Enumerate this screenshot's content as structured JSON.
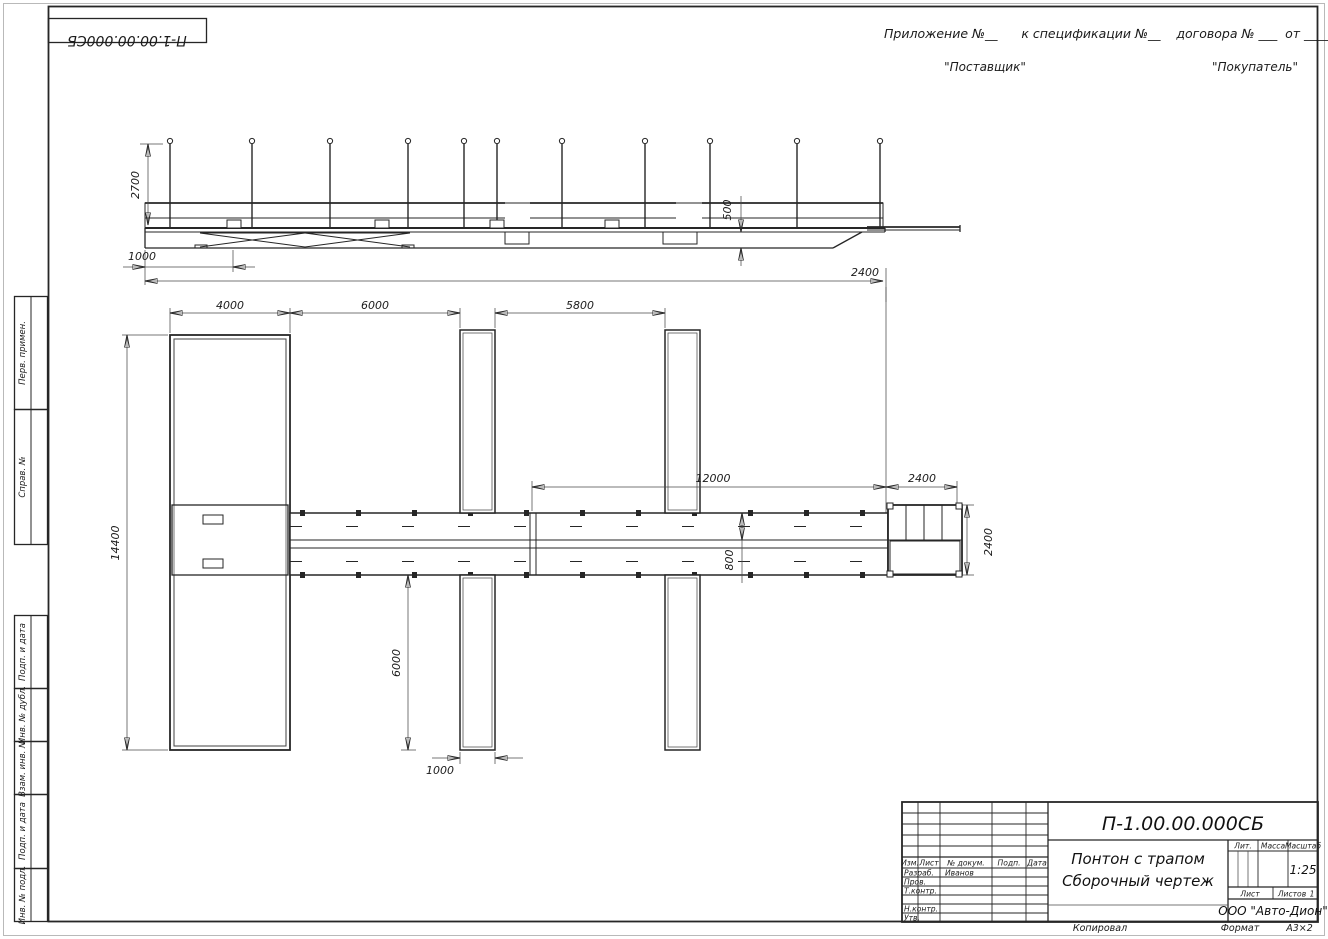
{
  "drawing": {
    "stamp_rotated": "П-1.00.00.000СБ",
    "appendix_line": "Приложение №__      к спецификации №__    договора № ___  от _________",
    "supplier": "\"Поставщик\"",
    "buyer": "\"Покупатель\"",
    "copied": "Копировал",
    "format_label": "Формат",
    "format_value": "А3×2"
  },
  "margin": {
    "perv": "Перв. примен.",
    "sprav": "Справ. №",
    "podp1": "Подп. и дата",
    "inv_dubl": "Инв. № дубл.",
    "vzam": "Взам. инв. №",
    "podp2": "Подп. и дата",
    "inv_podl": "Инв. № подл."
  },
  "dims": {
    "e_height": "2700",
    "e_offset": "1000",
    "e_draft": "500",
    "e_overall": "2400",
    "p1": "4000",
    "p2": "6000",
    "p3": "5800",
    "p4": "12000",
    "p5": "2400",
    "p_len": "14400",
    "p_walk": "800",
    "p_plat": "2400",
    "p_fing": "6000",
    "p_fw": "1000"
  },
  "title_block": {
    "doc_number": "П-1.00.00.000СБ",
    "title1": "Понтон с трапом",
    "title2": "Сборочный чертеж",
    "company": "ООО \"Авто-Дион\"",
    "cols": [
      "Изм.",
      "Лист",
      "№ докум.",
      "Подп.",
      "Дата"
    ],
    "roles": [
      "Разраб.",
      "Пров.",
      "Т.контр.",
      "Н.контр.",
      "Утв."
    ],
    "designer": "Иванов",
    "lit": "Лит.",
    "mass": "Масса",
    "scale_label": "Масштаб",
    "scale": "1:25",
    "sheet": "Лист",
    "sheets": "Листов",
    "sheets_value": "1"
  }
}
